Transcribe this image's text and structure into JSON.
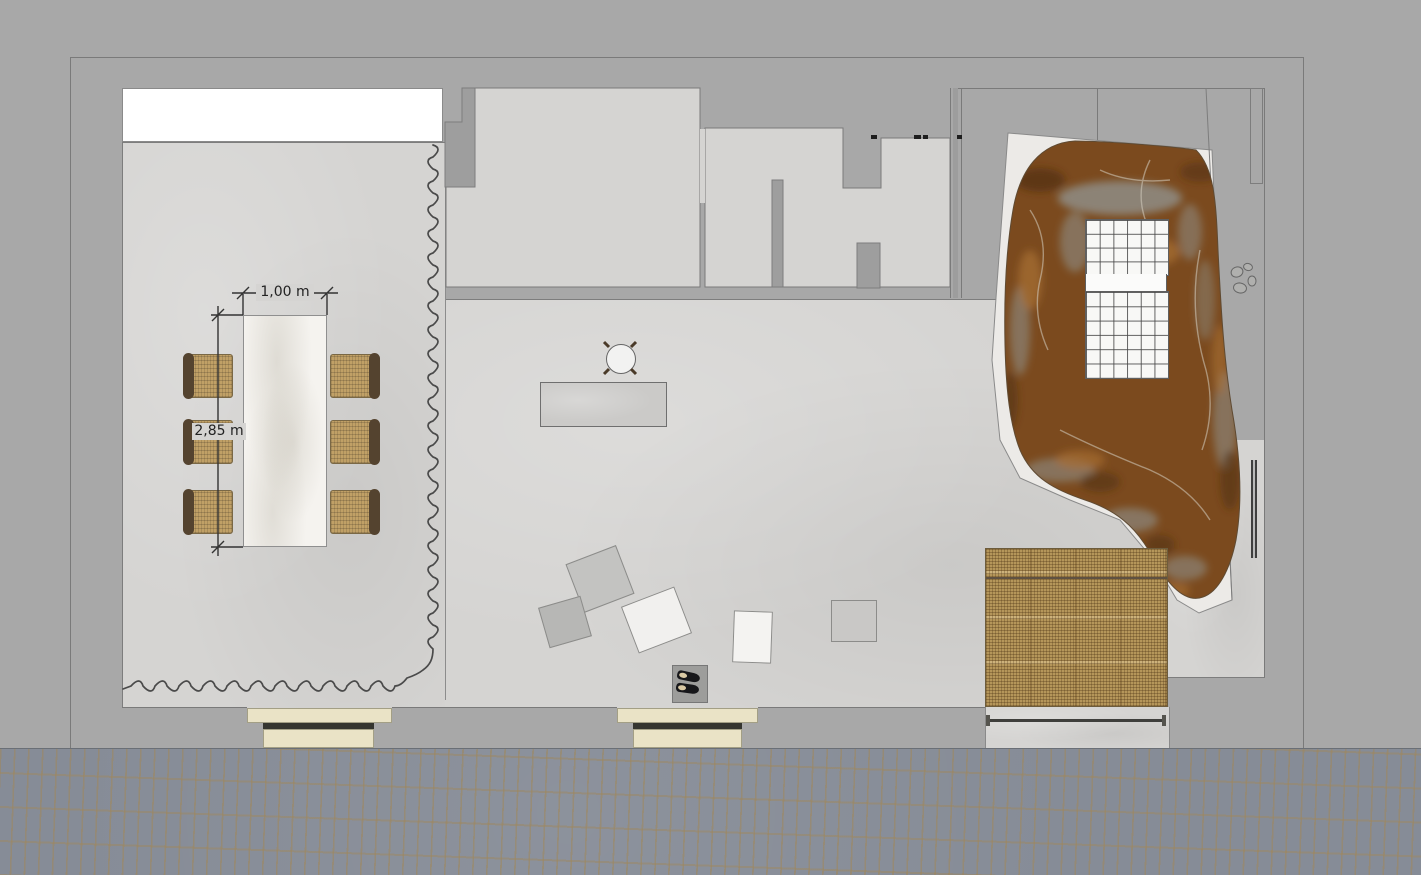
{
  "plan": {
    "type": "architectural-floor-plan",
    "dimension_labels": {
      "table_width": "1,00 m",
      "table_length": "2,85 m"
    },
    "colors": {
      "background": "#a8a8a8",
      "floor": "#d5d4d2",
      "wall_line": "#7a7a7a",
      "white_band": "#ffffff",
      "terrace": "#eceae7",
      "marble_brown": "#7b4a1e",
      "tile_white": "#f8f8f6",
      "rattan": "#b5965a",
      "chair_back": "#54432f",
      "step_cream": "#eae3c6",
      "step_dark": "#35352f",
      "pavement": "#868c97",
      "radiator": "#4c4c4c",
      "table_marble": "#f5f3ef",
      "curtain": "#4a4a4a",
      "dimension_text": "#222222"
    },
    "areas": [
      "dining-area",
      "living-area",
      "room-top-left",
      "room-top-middle",
      "room-top-right",
      "shower-terrace",
      "bed-niche",
      "street-pavement"
    ],
    "objects": [
      "dining-table",
      "dining-chairs-6",
      "curtain",
      "round-stool",
      "bench",
      "floor-cushions-5",
      "shoe-mat",
      "shoes-pair",
      "rattan-bed",
      "marble-boulder",
      "tiled-shower-grid",
      "pebbles",
      "radiator",
      "entry-steps-left",
      "entry-steps-center",
      "window-band",
      "door-marks"
    ]
  }
}
